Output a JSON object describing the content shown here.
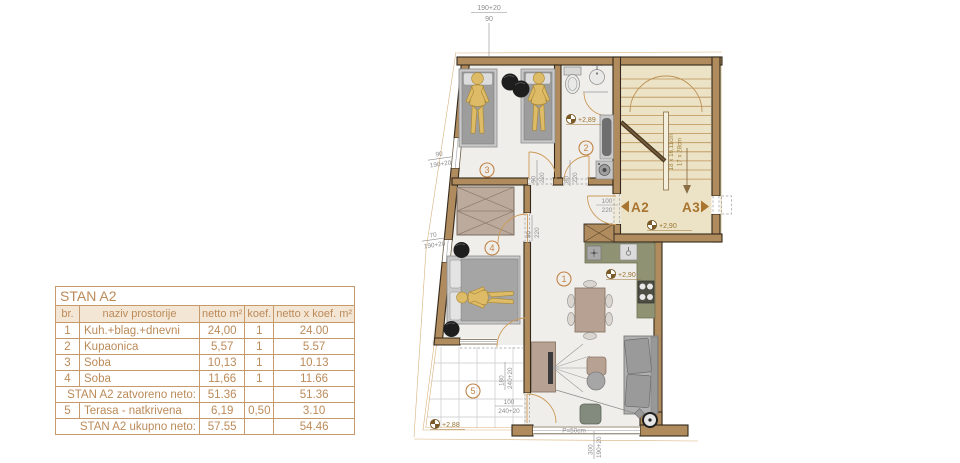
{
  "table": {
    "title": "STAN A2",
    "headers": [
      "br.",
      "naziv prostorije",
      "netto m²",
      "koef.",
      "netto x koef. m²"
    ],
    "rows": [
      {
        "br": "1",
        "name": "Kuh.+blag.+dnevni",
        "netto": "24,00",
        "koef": "1",
        "prod": "24.00"
      },
      {
        "br": "2",
        "name": "Kupaonica",
        "netto": "5,57",
        "koef": "1",
        "prod": "5.57"
      },
      {
        "br": "3",
        "name": "Soba",
        "netto": "10,13",
        "koef": "1",
        "prod": "10.13"
      },
      {
        "br": "4",
        "name": "Soba",
        "netto": "11,66",
        "koef": "1",
        "prod": "11.66"
      }
    ],
    "subtotal": {
      "label": "STAN A2 zatvoreno neto:",
      "netto": "51.36",
      "koef": "",
      "prod": "51.36"
    },
    "row5": {
      "br": "5",
      "name": "Terasa - natkrivena",
      "netto": "6,19",
      "koef": "0,50",
      "prod": "3.10"
    },
    "total": {
      "label": "STAN A2 ukupno neto:",
      "netto": "57.55",
      "koef": "",
      "prod": "54.46"
    }
  },
  "plan": {
    "rooms": {
      "r1": "1",
      "r2": "2",
      "r3": "3",
      "r4": "4",
      "r5": "5"
    },
    "units": {
      "a2": "A2",
      "a3": "A3"
    },
    "levels": {
      "bath": "+2,89",
      "living": "+2,90",
      "stair": "+2,90",
      "terrace": "+2,88"
    },
    "stair_note1": "18 x 16,11cm",
    "stair_note2": "17 x 28cm",
    "parapet": "P=50cm",
    "top_dim": {
      "num": "190+20",
      "den": "90"
    },
    "left_dim_1": {
      "num": "90",
      "den": "190+20"
    },
    "left_dim_2": {
      "num": "70",
      "den": "190+20"
    },
    "door_room3": {
      "num": "90",
      "den": "220"
    },
    "door_bath": {
      "num": "80",
      "den": "220"
    },
    "door_room4": {
      "num": "90",
      "den": "220"
    },
    "door_entrance": {
      "num": "100",
      "den": "220"
    },
    "terrace_window": {
      "num": "180",
      "den": "240+20"
    },
    "terrace_door": {
      "num": "100",
      "den": "240+20"
    },
    "bottom_dim": {
      "num": "300",
      "den": "190+20"
    }
  },
  "colors": {
    "table_accent": "#bc8a58",
    "plan_accent": "#c08448",
    "wall_fill": "#b08b5e",
    "stair_bg": "#ece3c6",
    "floor": "#f0eeea",
    "counter": "#8f9273",
    "figure": "#debb67"
  }
}
